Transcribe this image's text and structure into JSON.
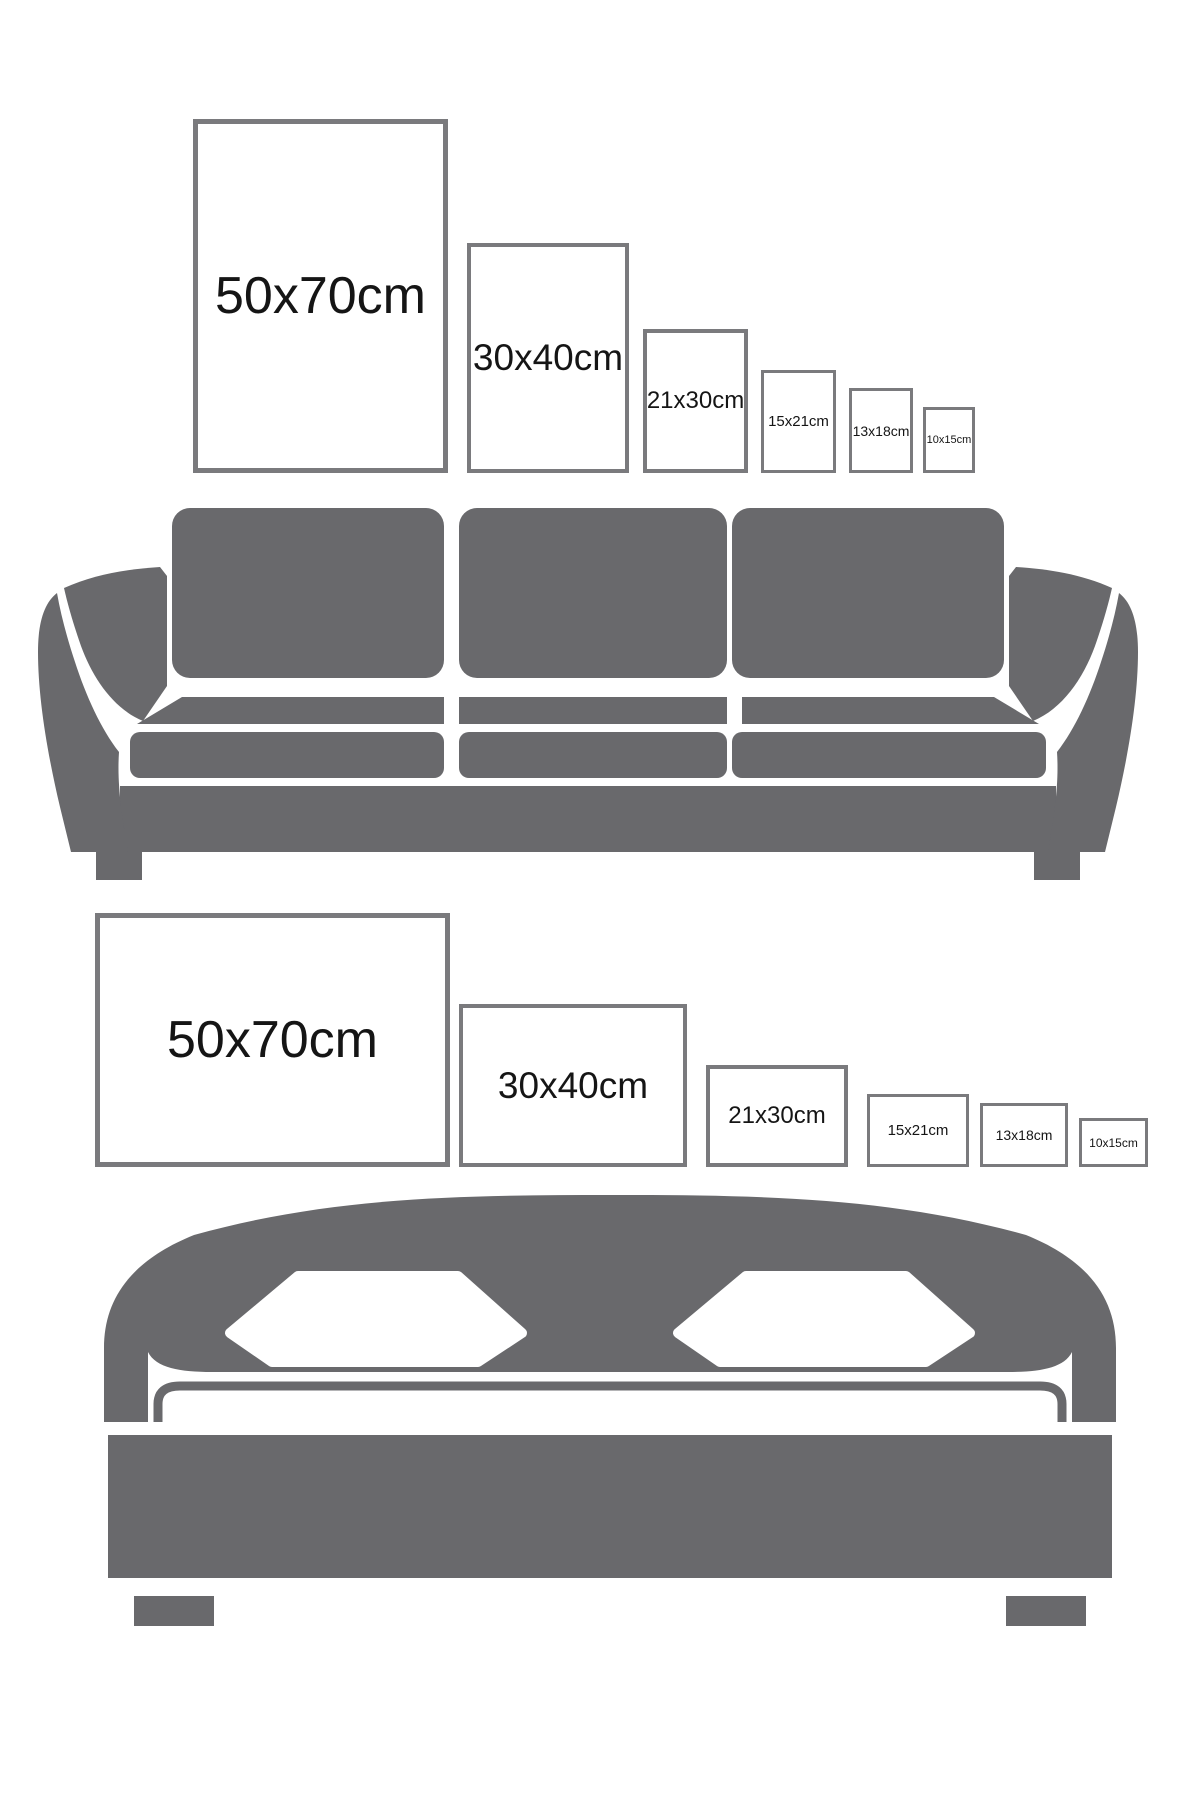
{
  "title": "Poster size guide",
  "palette": {
    "background": "#ffffff",
    "furniture_gray": "#69696c",
    "frame_border": "#7a7a7d",
    "label_color": "#151515"
  },
  "sections": [
    {
      "name": "sofa",
      "furniture_icon": "three-seat-sofa-silhouette",
      "frame_orientation": "portrait",
      "frames": [
        {
          "label": "50x70cm",
          "width_cm": 50,
          "height_cm": 70
        },
        {
          "label": "30x40cm",
          "width_cm": 30,
          "height_cm": 40
        },
        {
          "label": "21x30cm",
          "width_cm": 21,
          "height_cm": 30
        },
        {
          "label": "15x21cm",
          "width_cm": 15,
          "height_cm": 21
        },
        {
          "label": "13x18cm",
          "width_cm": 13,
          "height_cm": 18
        },
        {
          "label": "10x15cm",
          "width_cm": 10,
          "height_cm": 15
        }
      ]
    },
    {
      "name": "bed",
      "furniture_icon": "double-bed-silhouette",
      "frame_orientation": "landscape",
      "frames": [
        {
          "label": "50x70cm",
          "width_cm": 70,
          "height_cm": 50
        },
        {
          "label": "30x40cm",
          "width_cm": 40,
          "height_cm": 30
        },
        {
          "label": "21x30cm",
          "width_cm": 30,
          "height_cm": 21
        },
        {
          "label": "15x21cm",
          "width_cm": 21,
          "height_cm": 15
        },
        {
          "label": "13x18cm",
          "width_cm": 18,
          "height_cm": 13
        },
        {
          "label": "10x15cm",
          "width_cm": 15,
          "height_cm": 10
        }
      ]
    }
  ]
}
